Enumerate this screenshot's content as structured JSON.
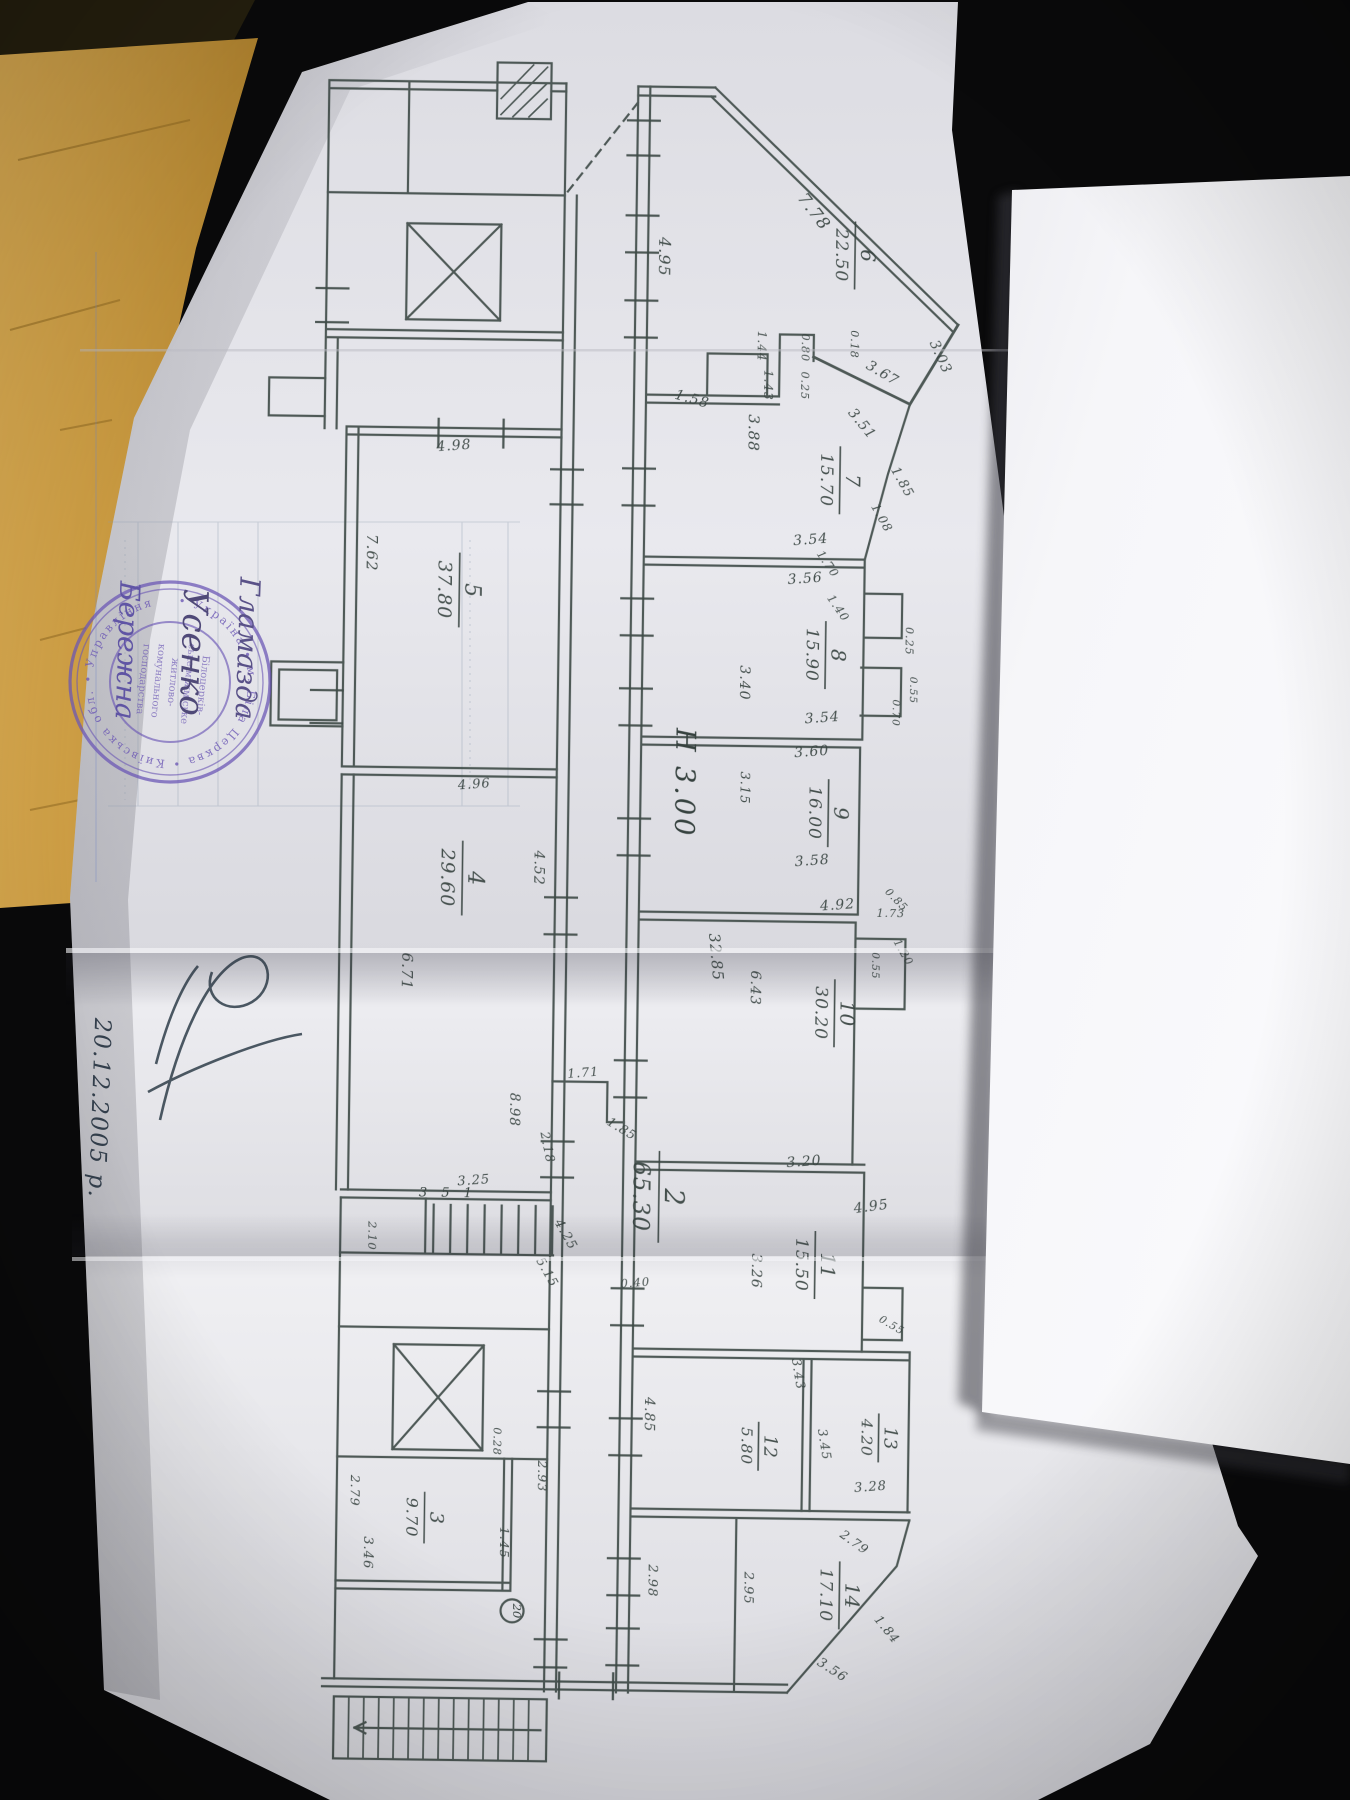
{
  "palette": {
    "background": "#0a0a0b",
    "envelope": "#d2a144",
    "paper": "#e6e6ea",
    "second_sheet": "#f4f4f7",
    "ink": "#3d4a46",
    "stamp": "#6c58b5",
    "pen_ink": "#2e3d49"
  },
  "plan": {
    "height_note": "Н 3.00",
    "stairs_note": "3 5 1",
    "circle_note": "20",
    "rooms": [
      {
        "num": "6",
        "area": "22.50"
      },
      {
        "num": "7",
        "area": "15.70"
      },
      {
        "num": "8",
        "area": "15.90"
      },
      {
        "num": "9",
        "area": "16.00"
      },
      {
        "num": "10",
        "area": "30.20"
      },
      {
        "num": "11",
        "area": "15.50"
      },
      {
        "num": "12",
        "area": "5.80"
      },
      {
        "num": "13",
        "area": "4.20"
      },
      {
        "num": "14",
        "area": "17.10"
      },
      {
        "num": "2",
        "area": "65.30"
      },
      {
        "num": "5",
        "area": "37.80"
      },
      {
        "num": "4",
        "area": "29.60"
      },
      {
        "num": "3",
        "area": "9.70"
      }
    ],
    "dims": [
      "7.78",
      "4.95",
      "3.03",
      "3.67",
      "1.44",
      "0.80",
      "0.18",
      "1.43",
      "0.25",
      "1.58",
      "3.88",
      "3.51",
      "1.85",
      "3.54",
      "3.56",
      "1.08",
      "0.25",
      "3.40",
      "3.54",
      "0.55",
      "0.70",
      "1.70",
      "1.40",
      "3.60",
      "3.15",
      "3.58",
      "0.85",
      "4.92",
      "1.73",
      "1.20",
      "0.55",
      "32.85",
      "6.43",
      "3.20",
      "4.95",
      "3.26",
      "0.40",
      "3.43",
      "0.55",
      "3.45",
      "3.28",
      "4.85",
      "4.25",
      "5.15",
      "2.98",
      "2.95",
      "2.79",
      "1.84",
      "3.56",
      "2.93",
      "0.28",
      "1.45",
      "2.79",
      "3.46",
      "7.62",
      "4.98",
      "4.96",
      "4.52",
      "6.71",
      "1.71",
      "2.18",
      "1.85",
      "3.25",
      "2.10",
      "8.98"
    ]
  },
  "stamp": {
    "ring_text": "• Україна • м. Біла Церква • Київська обл. • Управління ",
    "center_lines": [
      "Білоцерків-",
      "ське міжміське",
      "житлово-",
      "комунального",
      "господарства"
    ],
    "signatures": [
      "Гламазда",
      "Усенко",
      "Бережна"
    ]
  },
  "handwriting": {
    "date": "20.12.2005 р."
  }
}
